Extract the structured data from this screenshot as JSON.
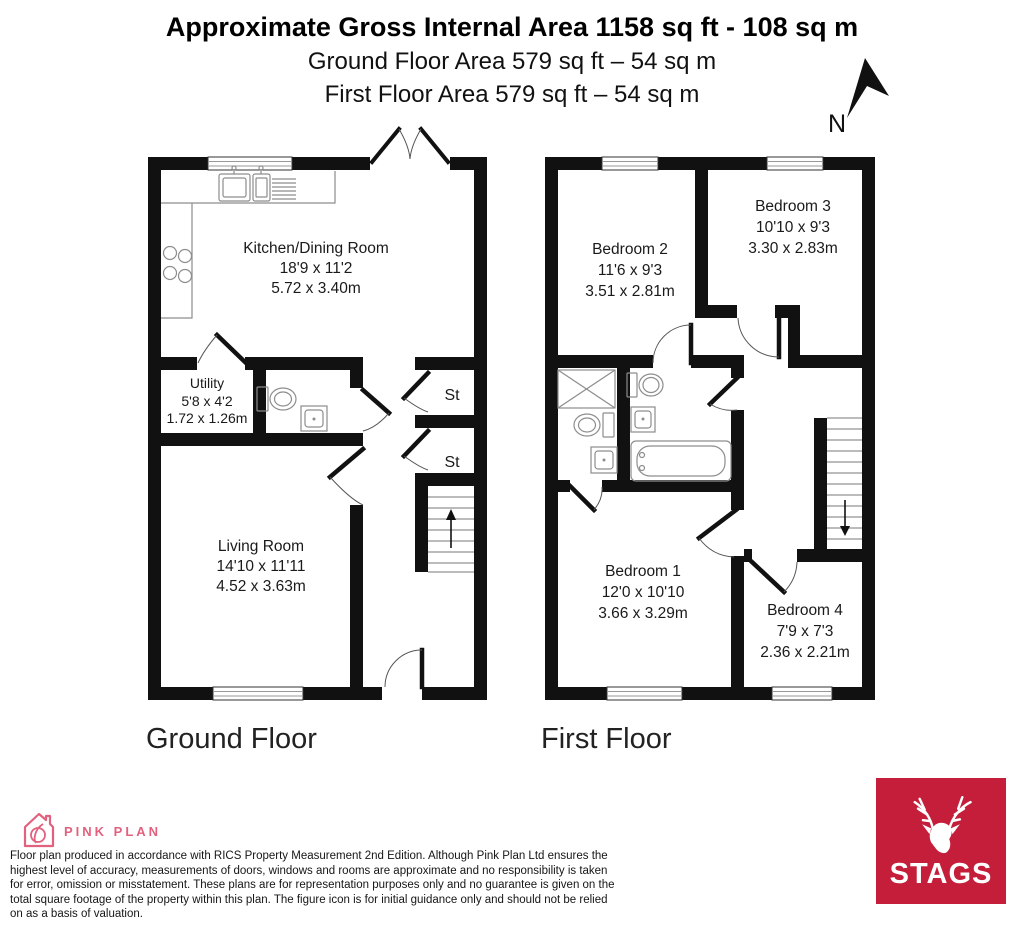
{
  "header": {
    "title": "Approximate Gross Internal Area 1158 sq ft - 108 sq m",
    "subtitle_ground": "Ground Floor Area 579 sq ft – 54 sq m",
    "subtitle_first": "First Floor Area 579 sq ft – 54 sq m",
    "north_label": "N"
  },
  "ground_floor": {
    "label": "Ground Floor",
    "rooms": {
      "kitchen": {
        "name": "Kitchen/Dining Room",
        "imperial": "18'9 x 11'2",
        "metric": "5.72 x 3.40m"
      },
      "utility": {
        "name": "Utility",
        "imperial": "5'8 x 4'2",
        "metric": "1.72 x 1.26m"
      },
      "living": {
        "name": "Living Room",
        "imperial": "14'10 x 11'11",
        "metric": "4.52 x 3.63m"
      },
      "store1": {
        "name": "St"
      },
      "store2": {
        "name": "St"
      }
    }
  },
  "first_floor": {
    "label": "First Floor",
    "rooms": {
      "bedroom1": {
        "name": "Bedroom 1",
        "imperial": "12'0 x 10'10",
        "metric": "3.66 x 3.29m"
      },
      "bedroom2": {
        "name": "Bedroom 2",
        "imperial": "11'6 x 9'3",
        "metric": "3.51 x 2.81m"
      },
      "bedroom3": {
        "name": "Bedroom 3",
        "imperial": "10'10 x 9'3",
        "metric": "3.30 x 2.83m"
      },
      "bedroom4": {
        "name": "Bedroom 4",
        "imperial": "7'9 x 7'3",
        "metric": "2.36 x 2.21m"
      }
    }
  },
  "footer": {
    "brand": "PINK PLAN",
    "disclaimer": "Floor plan produced in accordance with RICS Property Measurement 2nd Edition. Although Pink Plan Ltd ensures the highest level of accuracy, measurements of doors, windows and rooms are approximate and no responsibility is taken for error, omission or misstatement. These plans are for representation purposes only and no guarantee is given on the total square footage of the property within this plan. The figure icon is for initial guidance only and should not be relied on as a basis of valuation.",
    "agency": "STAGS"
  },
  "colors": {
    "wall": "#111111",
    "pink": "#e2617e",
    "stags_red": "#c41e3a"
  }
}
